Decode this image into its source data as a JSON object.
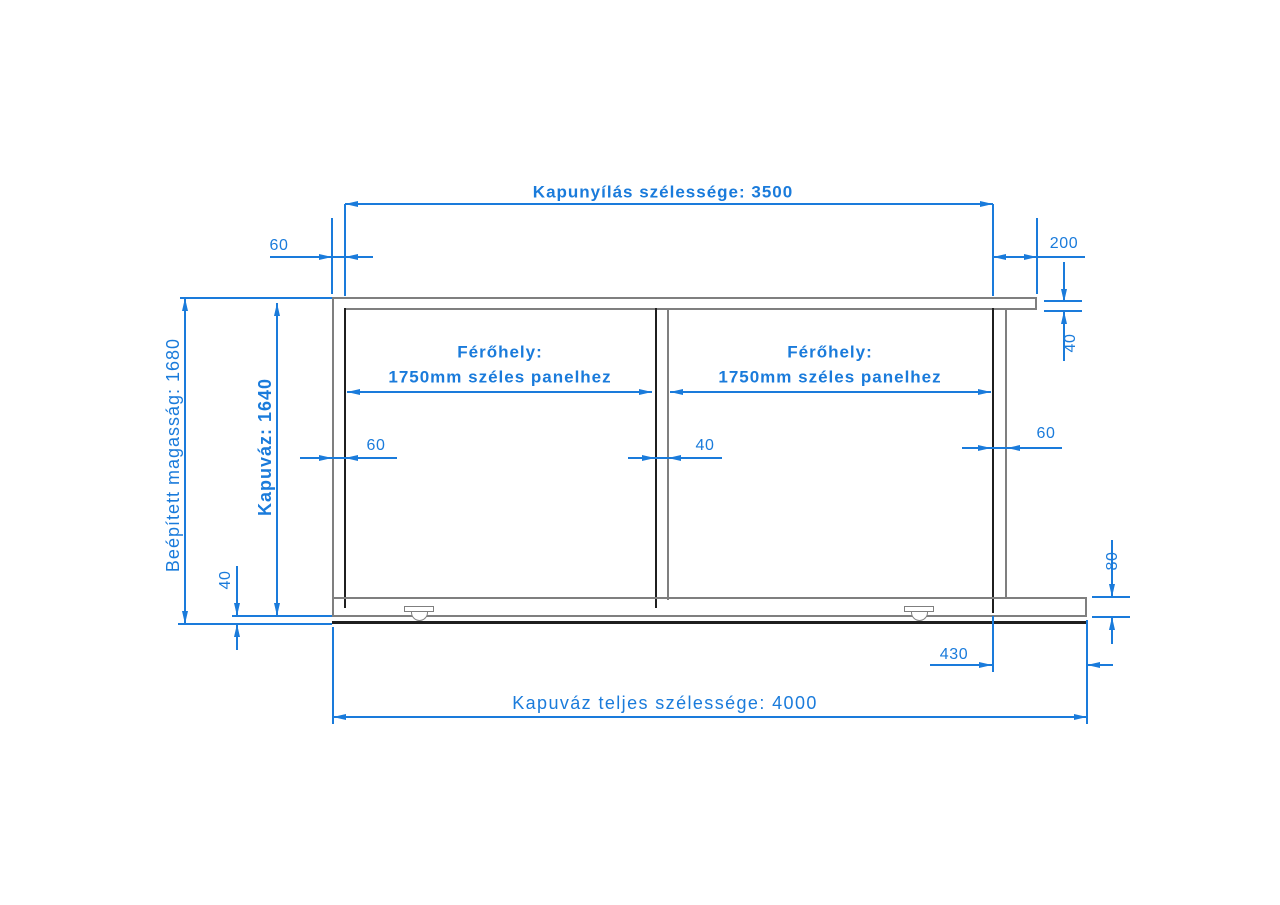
{
  "drawing": {
    "labels": {
      "opening_width": "Kapunyílás szélessége: 3500",
      "total_width": "Kapuváz teljes szélessége: 4000",
      "installed_height": "Beépített magasság: 1680",
      "frame_height": "Kapuváz: 1640",
      "panel_space_line1": "Férőhely:",
      "panel_space_line2": "1750mm széles panelhez"
    },
    "dimensions": {
      "left_post_width": "60",
      "right_overhang": "200",
      "top_rail_thickness": "40",
      "middle_post_width": "40",
      "right_post_width": "60",
      "bottom_clearance": "40",
      "bottom_rail_height": "80",
      "rail_overhang": "430"
    },
    "colors": {
      "dimension_blue": "#1a7bdb",
      "structure_gray": "#7f7f7f",
      "structure_dark": "#1f1f1f",
      "background": "#ffffff"
    }
  }
}
